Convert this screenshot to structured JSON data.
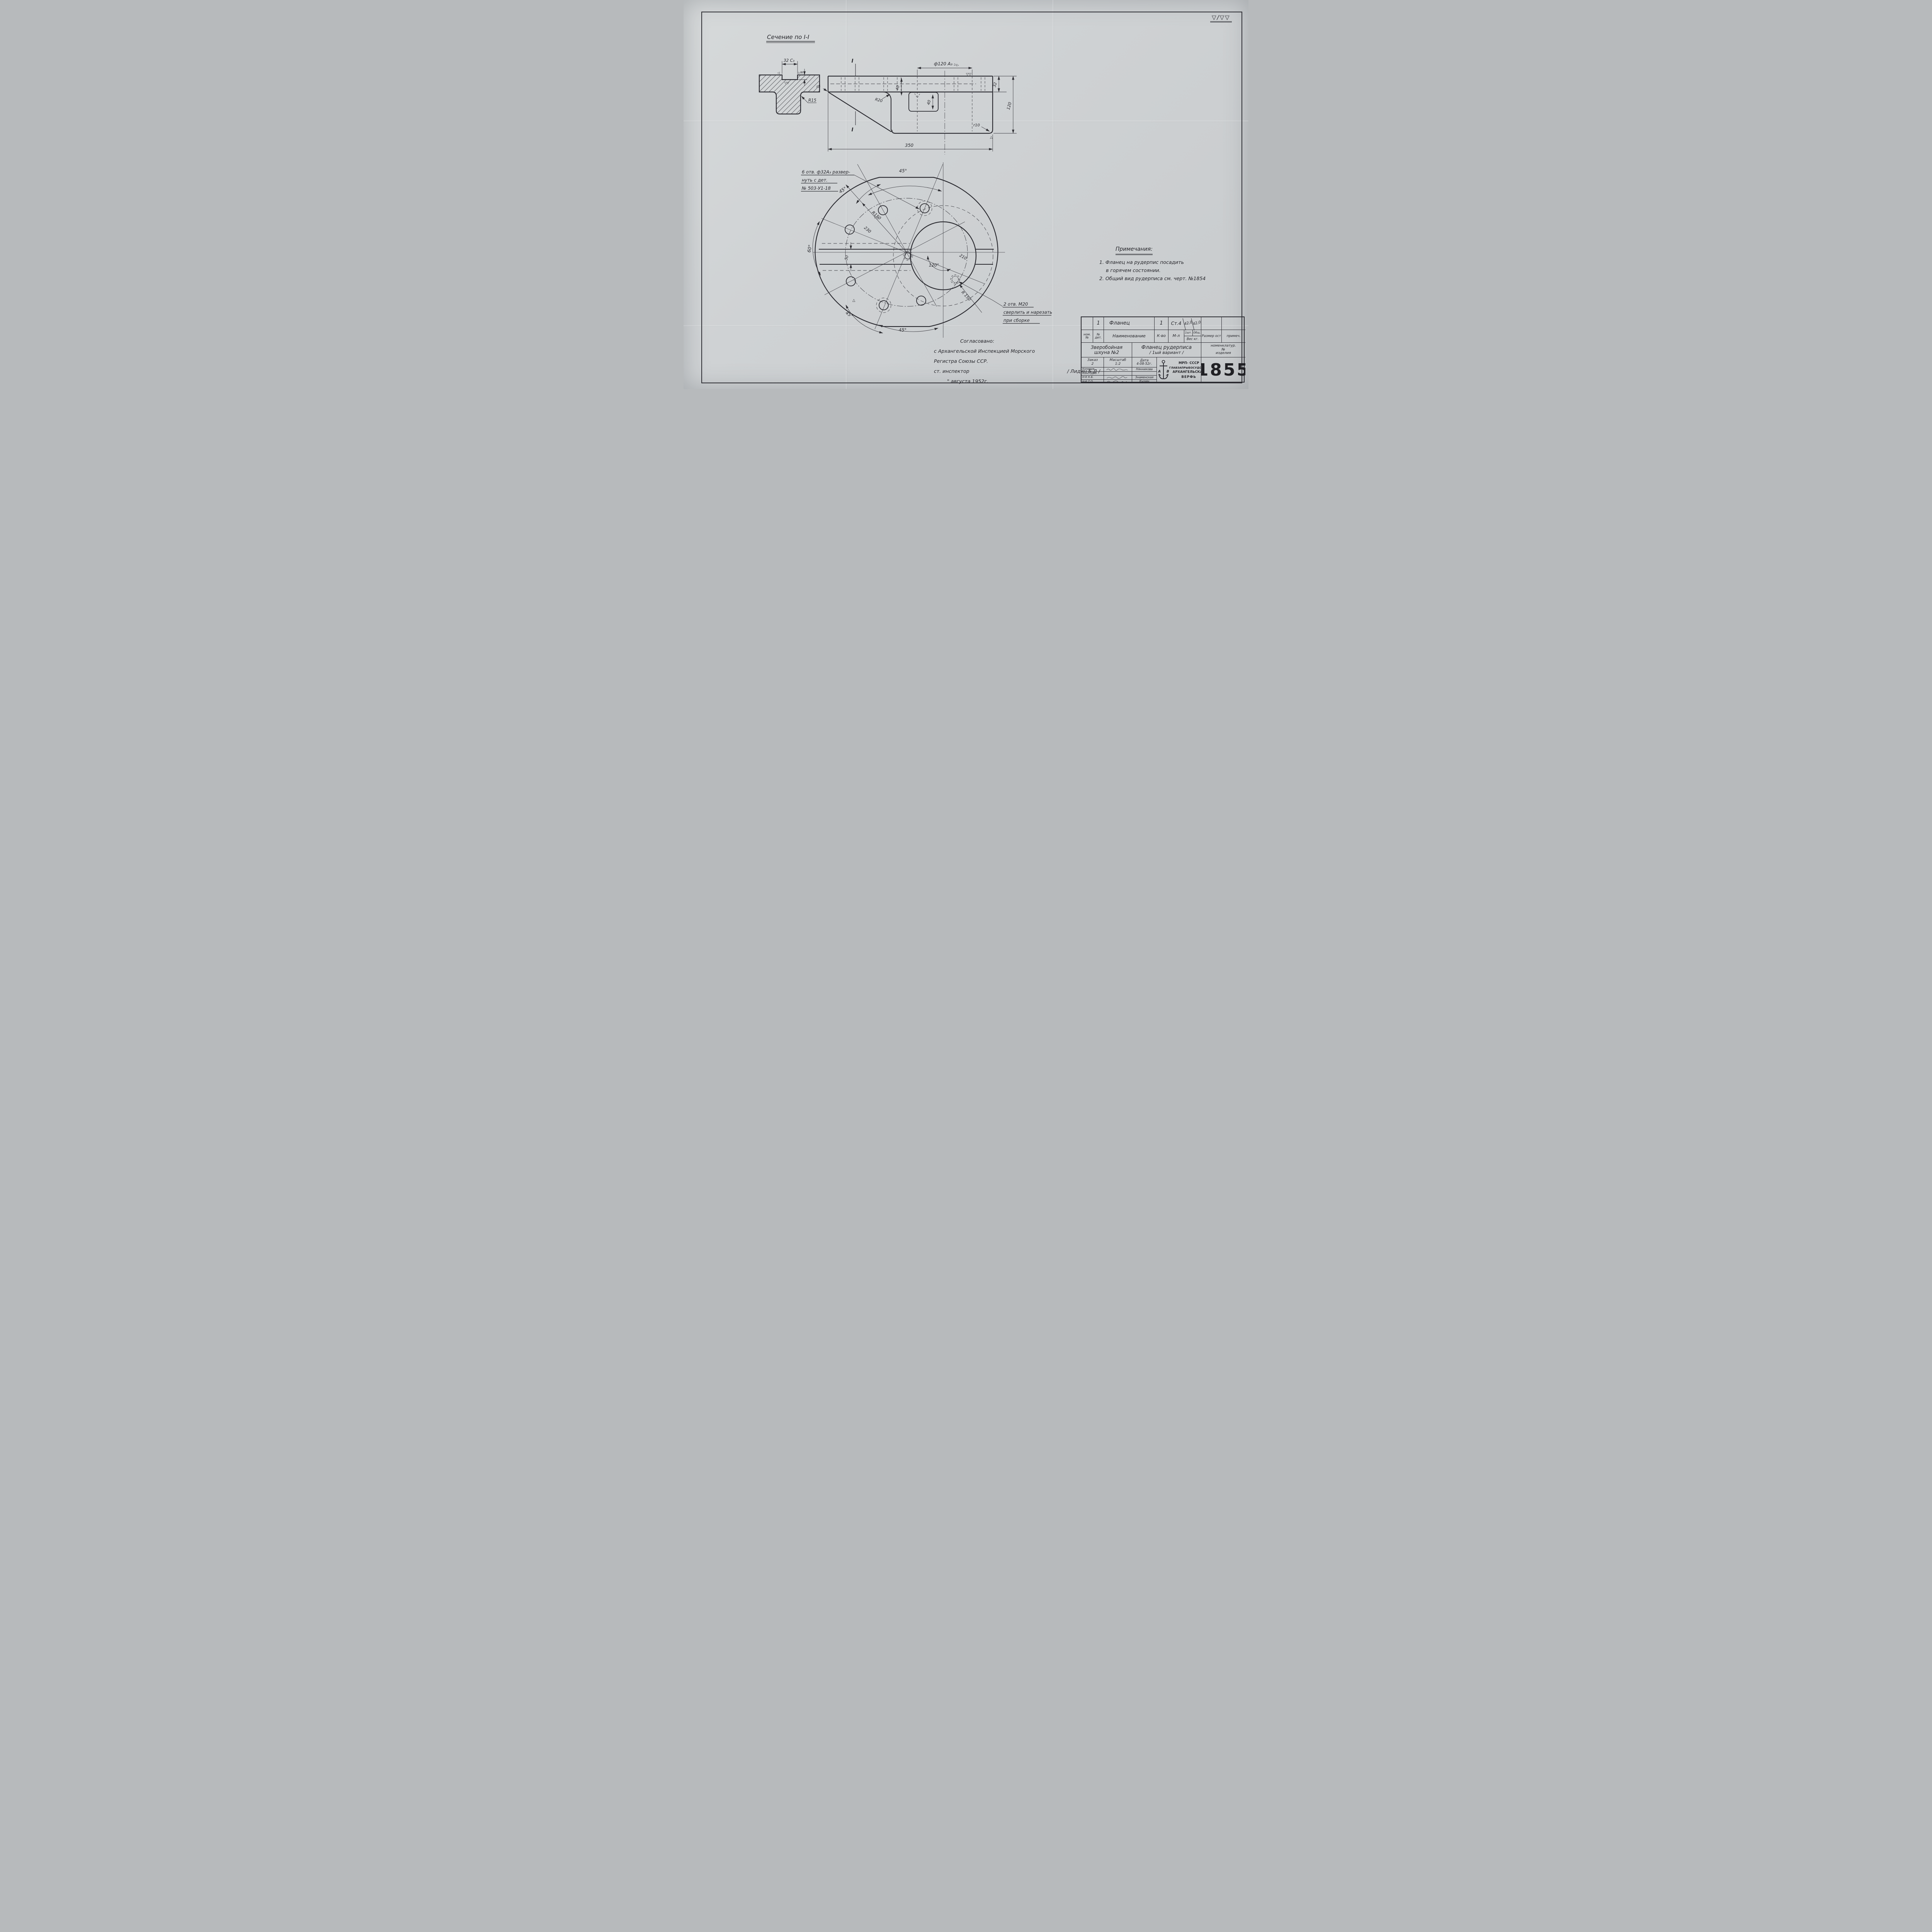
{
  "page": {
    "corner_mark": "▽/▽▽"
  },
  "section_view": {
    "title": "Сечение по I-I",
    "dim_width": "32 C₃",
    "dim_depth": "6",
    "fillet": "R15",
    "finish_groove": "▽▽",
    "flag_left": "◁",
    "flag_right": "▷"
  },
  "side_view": {
    "section_mark_top": "I",
    "section_mark_bottom": "I",
    "dim_bore": "ф120 А₃",
    "dim_40_top": "40",
    "dim_40_key": "40",
    "dim_32": "32",
    "dim_120": "120",
    "dim_350": "350",
    "r20": "R20",
    "r10": "r10",
    "r5": "r5",
    "finish_top": "▽▽",
    "finish_flags": "▷▷",
    "finish_bottom": "△"
  },
  "flange_view": {
    "note_holes_l1": "6 отв. ф32А₃ развер-",
    "note_holes_l2": "нуть с дет.",
    "note_holes_l3": "№ 503-У1-18",
    "note_m20_l1": "2 отв. М20",
    "note_m20_l2": "сверлить и нарезать",
    "note_m20_l3": "при сборке",
    "angle_top": "45°",
    "angle_upper_left": "45°",
    "angle_left": "60°",
    "angle_bottom_left": "45°",
    "angle_bottom": "45°",
    "angle_center": "120°",
    "r150_upper": "R150",
    "dim_230": "230",
    "dim_210": "210",
    "r150_lower": "R 150",
    "dim_keyway": "50",
    "finish_hole": "▽▽",
    "finish_rim": "△"
  },
  "notes": {
    "title": "Примечания:",
    "item1_l1": "1. Фланец на рудерпис посадить",
    "item1_l2": "в горячем состоянии.",
    "item2": "2. Общий вид рудерписа см. черт. №1854"
  },
  "approval": {
    "line1": "Согласовано:",
    "line2": "с Архангельской Инспекцией Морского",
    "line3": "Регистра Союзы ССР.",
    "line4": "ст. инспектор",
    "signature": "/ Лидин Б.Д /",
    "line5": "\"  августа 1952г."
  },
  "title_block": {
    "parts_row": {
      "det_no": "1",
      "name": "Фланец",
      "qty": "1",
      "material": "Ст.4",
      "weight_item": "42,0",
      "weight_total": "42,0"
    },
    "headers": {
      "nom_no": "ном. №",
      "det_no": "№ дет.",
      "name": "Наименование",
      "qty": "К-во",
      "material": "М-л",
      "weight_item": "1шт.",
      "weight_total": "Общ.",
      "weight": "Вес кг.",
      "size": "Размер ост",
      "note": "примеч."
    },
    "project_l1": "Зверобойная",
    "project_l2": "шхуна №2",
    "title_l1": "Фланец рудерписа",
    "title_l2": "/ 1ый вариант /",
    "nomen_l1": "номенклатур.",
    "nomen_l2": "№",
    "nomen_l3": "изделия",
    "order_label": "Заказ",
    "order_value": "2",
    "scale_label": "Масштаб",
    "scale_value": "1:2",
    "date_label": "Дата",
    "date_value": "4-08-52г.",
    "row1_label": "Копиров.",
    "row1_name": "Нянникова",
    "row2_label": "Конструк.",
    "row2_name": "",
    "row3_label": "Н-К К.Б.",
    "row3_name": "Знаменская",
    "row4_label": "Н-К Т.О.",
    "row4_name": "Кычин",
    "org_l1": "МРП- СССР",
    "org_l2": "ГЛАВЗАПРЫБОСУДОСТР.",
    "org_l3": "АРХАНГЕЛЬСКАЯ",
    "org_l4": "ВЕРФЬ",
    "logo_left": "А",
    "logo_right": "В",
    "number": "1855"
  }
}
